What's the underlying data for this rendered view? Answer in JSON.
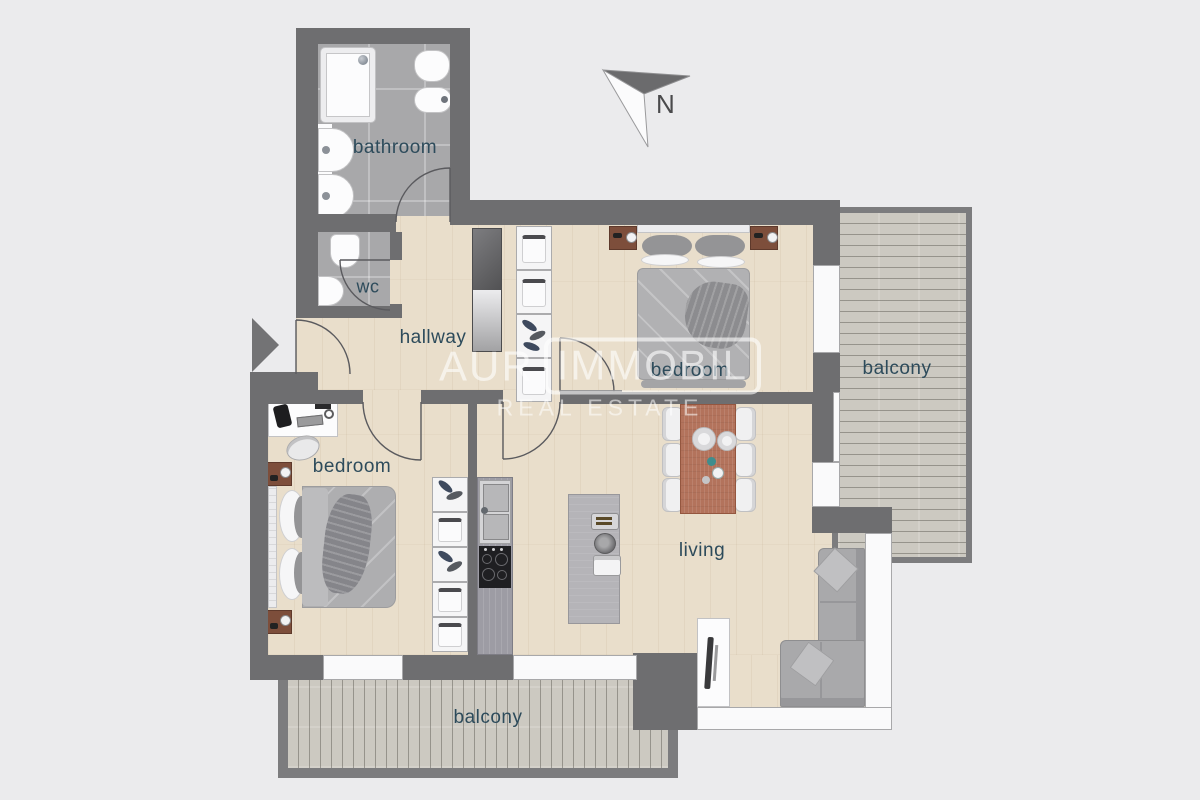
{
  "page": {
    "type": "apartment-floor-plan"
  },
  "compass": {
    "label": "N"
  },
  "watermark": {
    "brand_prefix": "AUR",
    "brand_boxed": "IMMOBIL",
    "tagline": "REAL ESTATE"
  },
  "rooms": {
    "bathroom": {
      "label": "bathroom",
      "floor": "tile",
      "furniture": [
        "shower",
        "toilet",
        "bidet",
        "washbasin",
        "washbasin"
      ]
    },
    "wc": {
      "label": "wc",
      "floor": "tile",
      "furniture": [
        "toilet",
        "washbasin"
      ]
    },
    "hallway": {
      "label": "hallway",
      "floor": "wood",
      "furniture": [
        "tall-cabinet"
      ]
    },
    "bedroom_top": {
      "label": "bedroom",
      "floor": "wood",
      "furniture": [
        "double-bed",
        "nightstand",
        "nightstand",
        "wardrobe-shelves"
      ]
    },
    "bedroom_left": {
      "label": "bedroom",
      "floor": "wood",
      "furniture": [
        "double-bed",
        "nightstand",
        "nightstand",
        "desk",
        "desk-chair",
        "wardrobe-shelves"
      ]
    },
    "living": {
      "label": "living",
      "floor": "wood",
      "furniture": [
        "dining-table",
        "six-chairs",
        "kitchen-counter",
        "sink",
        "cooktop",
        "kitchen-island",
        "corner-sofa",
        "tv-sideboard"
      ]
    },
    "balcony_right": {
      "label": "balcony",
      "floor": "deck-horizontal"
    },
    "balcony_bottom": {
      "label": "balcony",
      "floor": "deck-vertical"
    }
  },
  "colors": {
    "bg": "#ebebed",
    "wall": "#6e6e70",
    "wood_floor": "#e9decb",
    "tile_floor": "#a8a8aa",
    "deck": "#ccc9c1",
    "label_text": "#2d4b5b",
    "accent_table": "#b3735c",
    "nightstand_brown": "#7d4e3b",
    "sofa_gray": "#a9a9ab",
    "watermark": "rgba(255,255,255,0.6)"
  }
}
